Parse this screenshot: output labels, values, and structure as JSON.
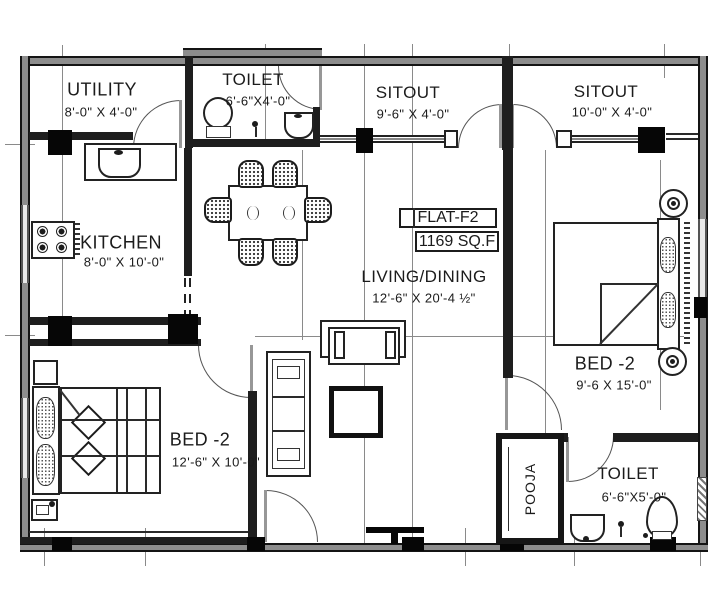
{
  "plan": {
    "flat_label": "FLAT-F2",
    "flat_area": "1169 SQ.F",
    "rooms": {
      "utility": {
        "name": "UTILITY",
        "dims": "8'-0\" X 4'-0\""
      },
      "toilet_top": {
        "name": "TOILET",
        "dims": "6'-6\"X4'-0\""
      },
      "sitout_left": {
        "name": "SITOUT",
        "dims": "9'-6\" X 4'-0\""
      },
      "sitout_right": {
        "name": "SITOUT",
        "dims": "10'-0\" X 4'-0\""
      },
      "kitchen": {
        "name": "KITCHEN",
        "dims": "8'-0\" X 10'-0\""
      },
      "living": {
        "name": "LIVING/DINING",
        "dims": "12'-6\" X 20'-4 ½\""
      },
      "bed_right": {
        "name": "BED -2",
        "dims": "9'-6 X 15'-0\""
      },
      "bed_left": {
        "name": "BED -2",
        "dims": "12'-6\" X 10'-0\""
      },
      "pooja": {
        "name": "POOJA"
      },
      "toilet_bottom": {
        "name": "TOILET",
        "dims": "6'-6\"X5'-0\""
      }
    },
    "colors": {
      "line": "#1e1e1e",
      "wall_core": "#8d8d8d",
      "window": "#8f8f8f",
      "text": "#1b1b1b",
      "background": "#ffffff"
    }
  }
}
